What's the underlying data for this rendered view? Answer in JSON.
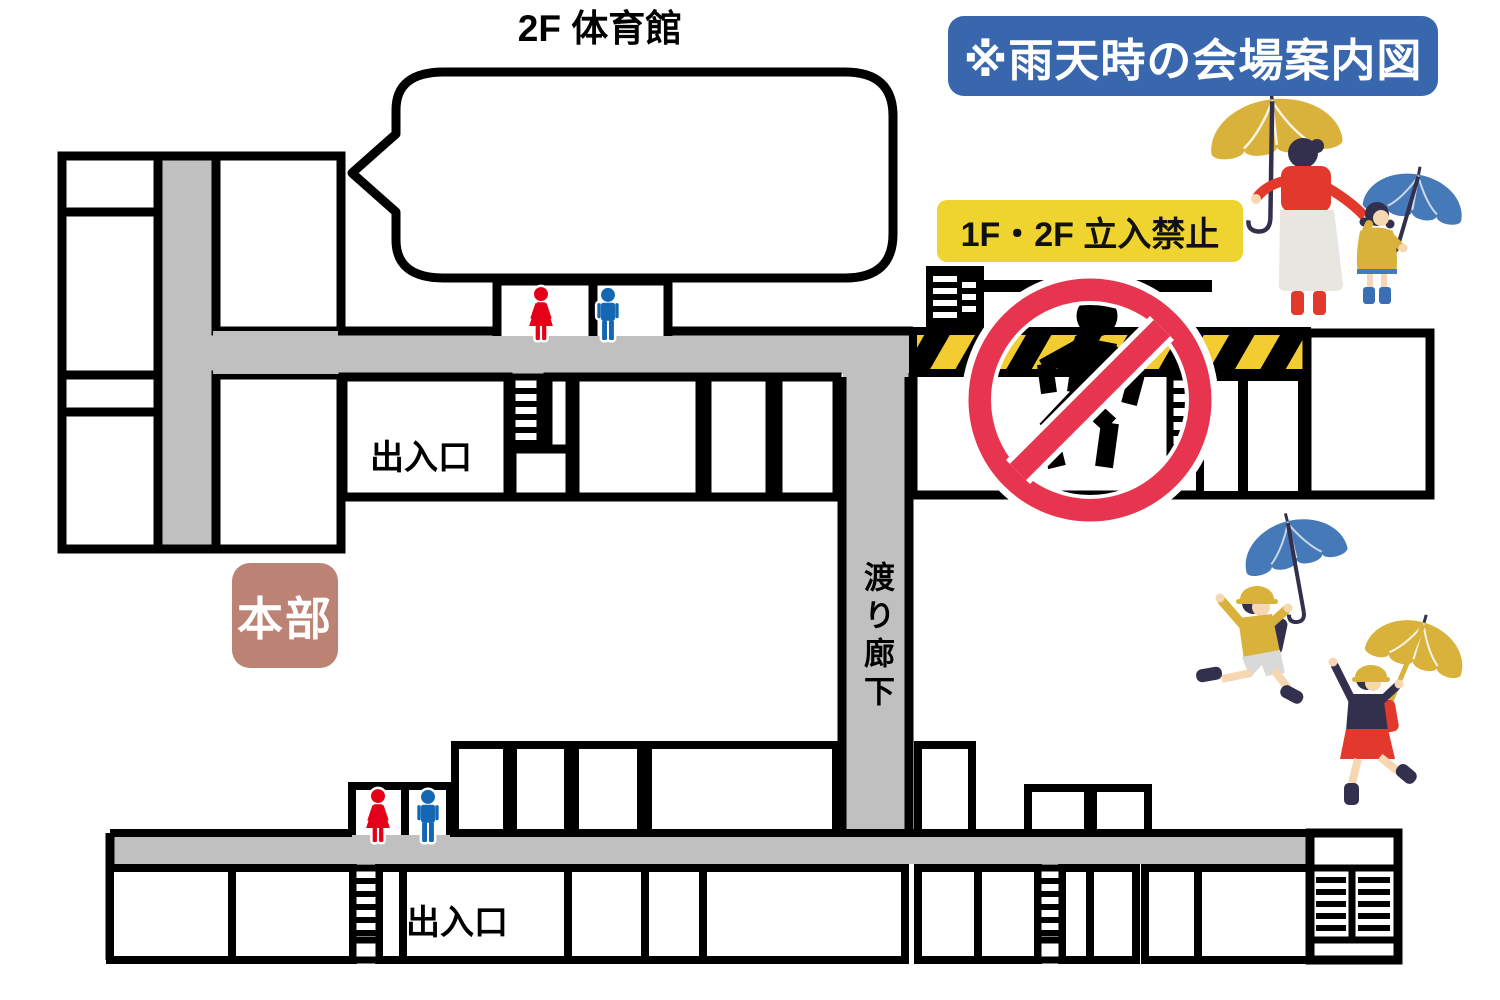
{
  "header": {
    "title_badge": "※雨天時の会場案内図"
  },
  "labels": {
    "gym": "2F 体育館",
    "no_entry": "1F・2F 立入禁止",
    "headquarters": "本部",
    "entrance_top": "出入口",
    "entrance_bottom": "出入口",
    "connecting_corridor": "渡り廊下"
  },
  "icons": {
    "no_entry_sign": "no-entry-running-person",
    "female_restroom": "female-pictogram",
    "male_restroom": "male-pictogram",
    "stairs": "stairs-ladder",
    "hazard_barrier": "yellow-black-hazard-stripe",
    "speech_bubble": "empty-callout-bubble-from-gym",
    "illustrations": [
      "mother-and-child-with-umbrellas",
      "children-jumping-with-umbrellas"
    ]
  },
  "colors": {
    "wall": "#000000",
    "corridor_gray": "#C1C0C0",
    "badge_blue": "#3867AD",
    "badge_yellow": "#EFD32E",
    "headquarters_brown": "#BC8374",
    "prohibition_red": "#E8354F",
    "hazard_yellow": "#F2CC30",
    "female_red": "#E50019",
    "male_blue": "#1467B3",
    "navy": "#33304E",
    "skin": "#F6D7B2",
    "umbrella_yellow": "#D9B23C",
    "umbrella_blue": "#4679B8",
    "red": "#E2392C",
    "light_gray": "#E8E6E0",
    "shorts_gray": "#D9D9D9",
    "coat_yellow": "#D9B23C",
    "boots_blue": "#3B6FB5",
    "white": "#FFFFFF"
  }
}
